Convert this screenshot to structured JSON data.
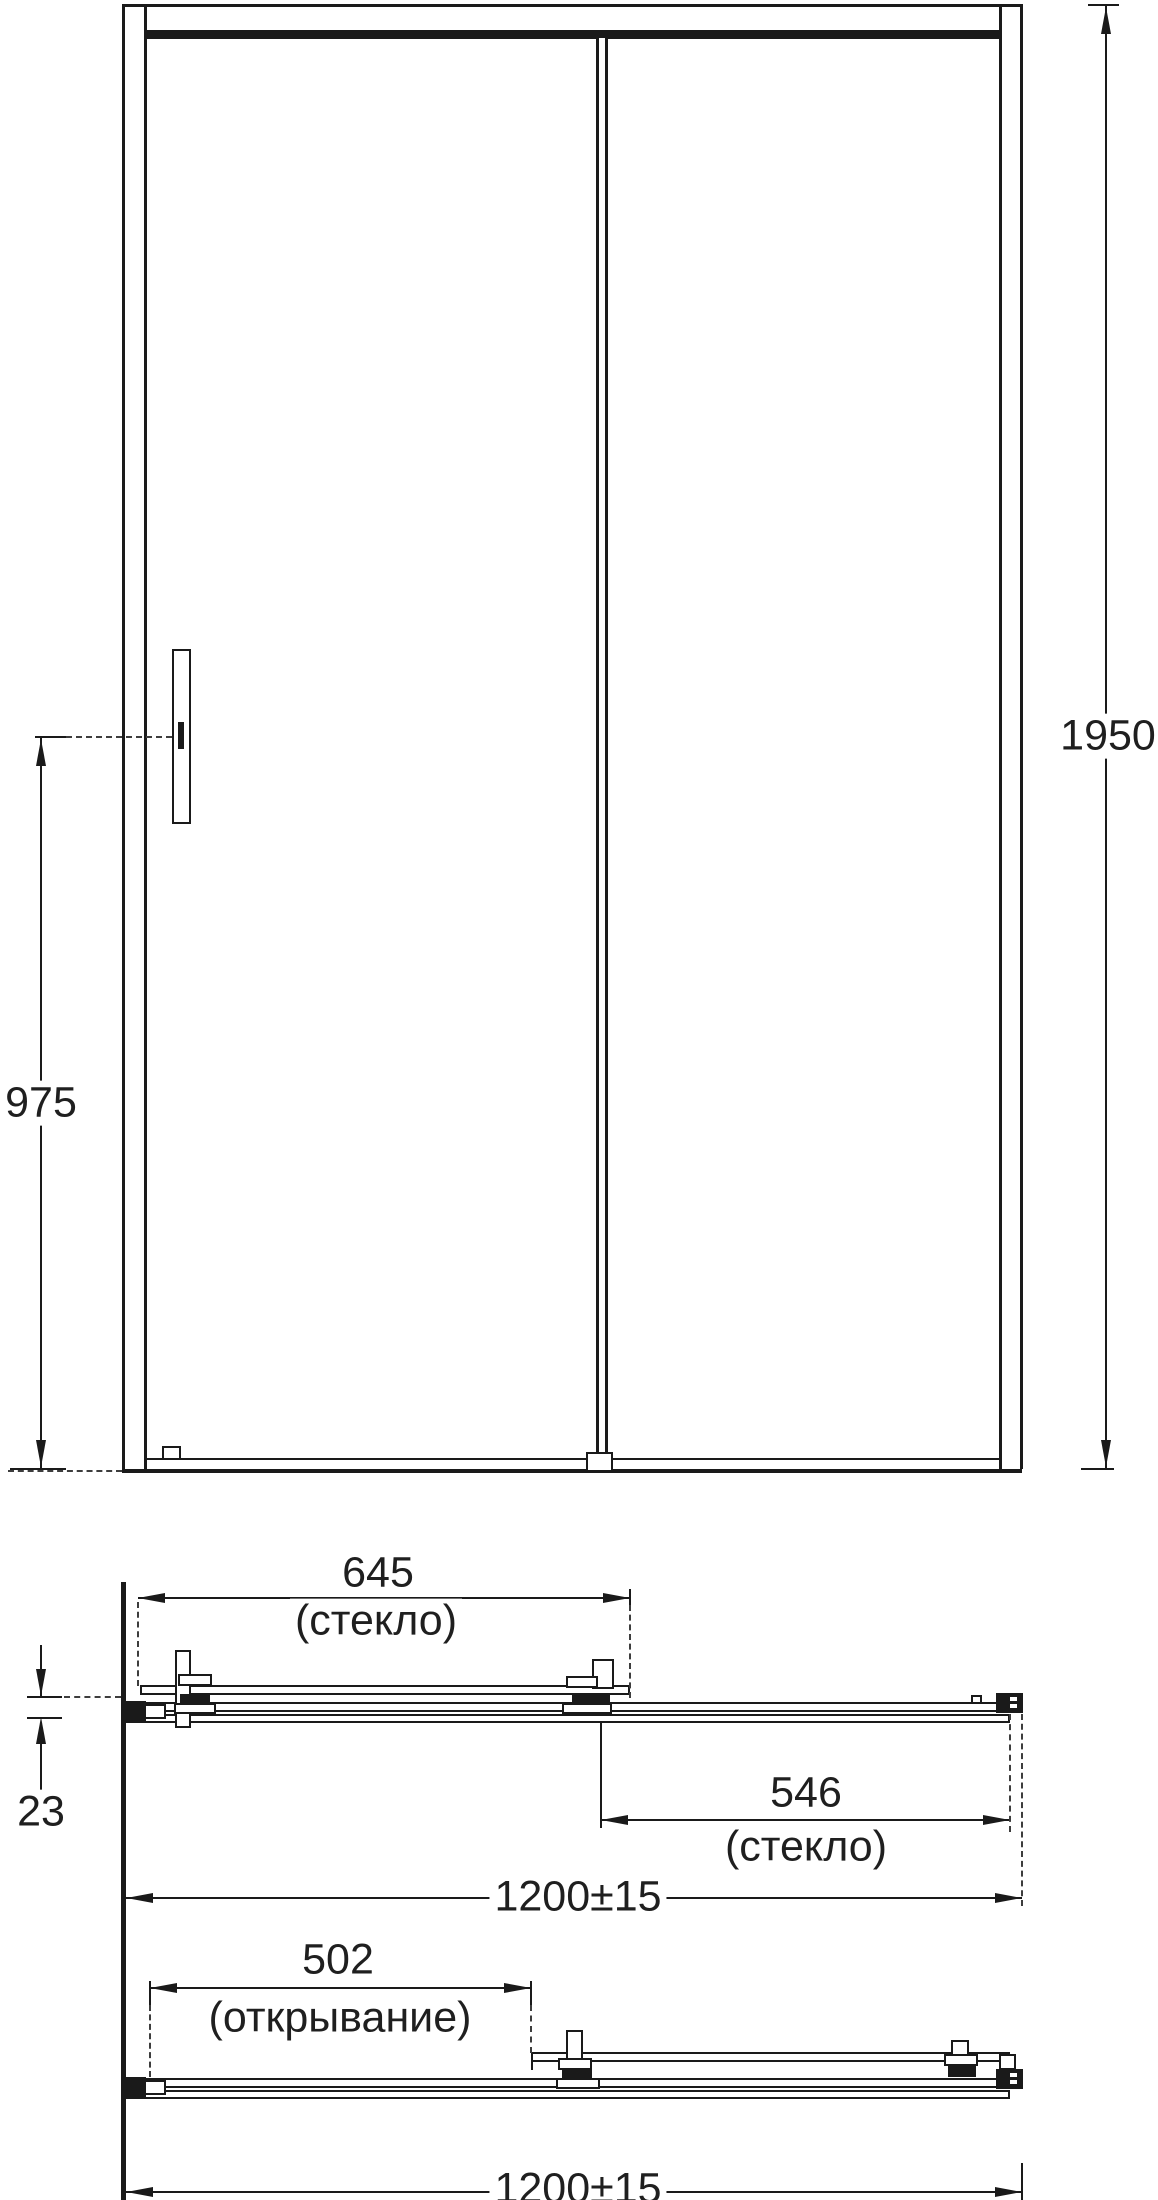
{
  "views": {
    "front_elevation": {
      "dimensions": [
        {
          "name": "overall-height",
          "value": "1950"
        },
        {
          "name": "handle-center-height",
          "value": "975"
        }
      ]
    },
    "plan_closed": {
      "dimensions": [
        {
          "name": "sliding-glass-width",
          "value": "645",
          "note": "(стекло)"
        },
        {
          "name": "fixed-glass-width",
          "value": "546",
          "note": "(стекло)"
        },
        {
          "name": "glass-plane-offset",
          "value": "23"
        },
        {
          "name": "overall-width",
          "value": "1200±15"
        }
      ]
    },
    "plan_open": {
      "dimensions": [
        {
          "name": "opening-width",
          "value": "502",
          "note": "(открывание)"
        },
        {
          "name": "overall-width",
          "value": "1200±15"
        }
      ]
    }
  },
  "style": {
    "line_color": "#1a1a1a",
    "dash_color": "#3d3d3d",
    "background": "#ffffff"
  }
}
